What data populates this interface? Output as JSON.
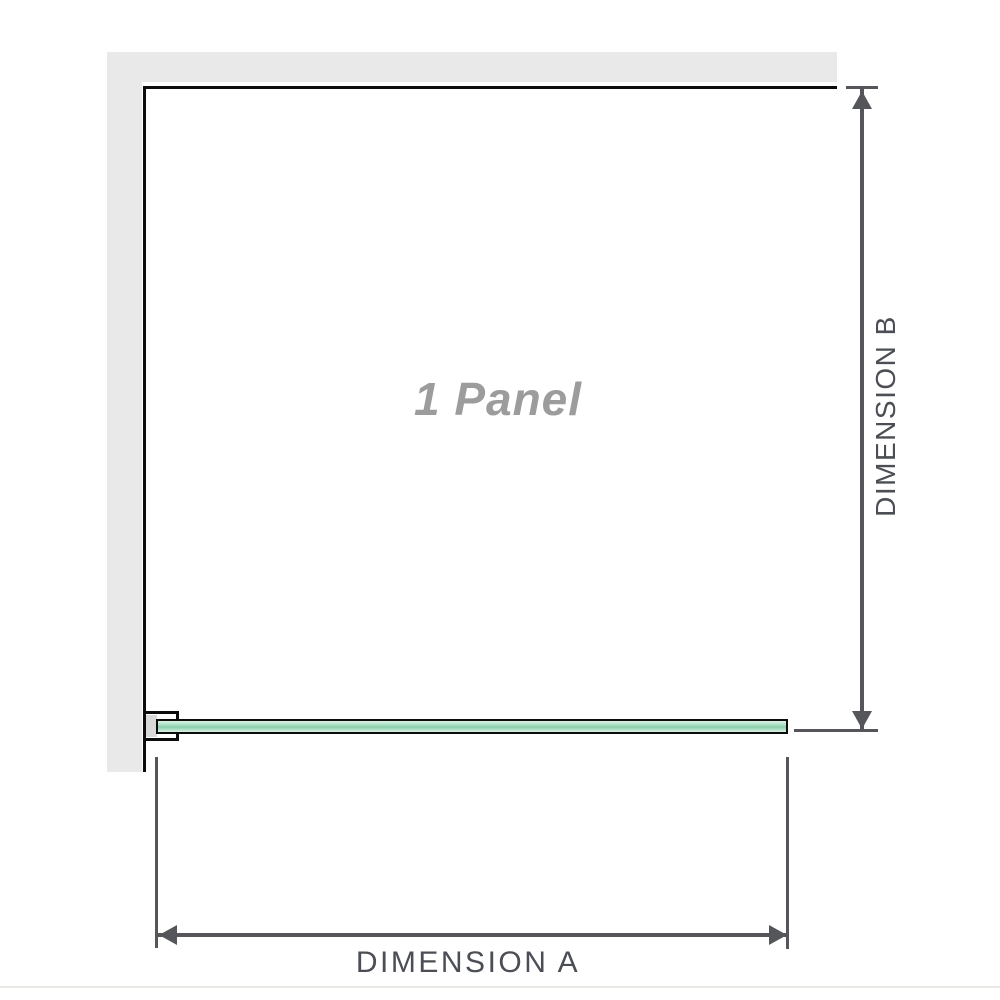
{
  "diagram": {
    "panel_label": "1 Panel",
    "dimension_a_label": "DIMENSION A",
    "dimension_b_label": "DIMENSION B"
  },
  "colors": {
    "background": "#ffffff",
    "wall_fill": "#e9e9e9",
    "outline": "#0c0c0c",
    "dimension_line": "#54565a",
    "dimension_text": "#4b4e54",
    "panel_label_text": "#9c9c9c",
    "glass_light": "#ddf3e7",
    "glass_mid": "#a9dfc2",
    "glass_dark": "#8ccfad",
    "bracket_pad": "#d9d9d9",
    "photo_edge_line": "#e8e8e4"
  }
}
